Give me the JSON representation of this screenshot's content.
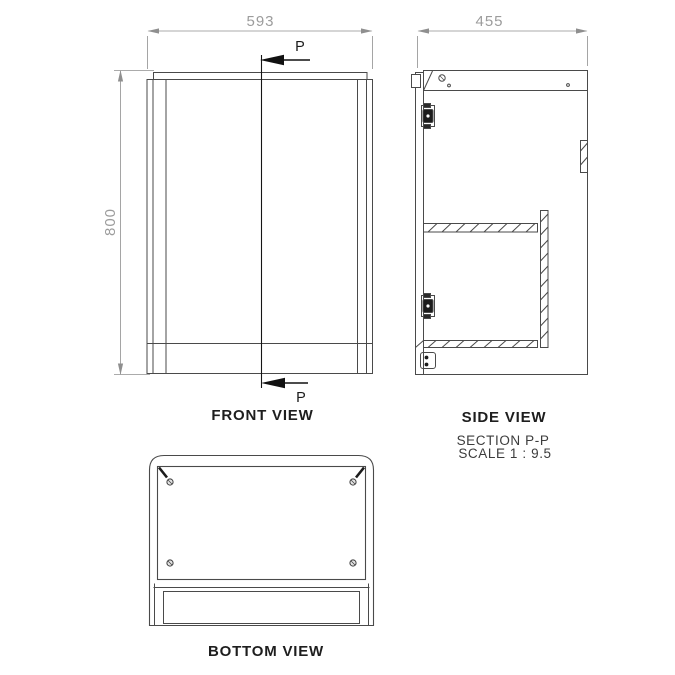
{
  "drawing": {
    "title_labels": {
      "front_view": "FRONT VIEW",
      "side_view": "SIDE VIEW",
      "section": "SECTION P-P",
      "scale": "SCALE 1 : 9.5",
      "bottom_view": "BOTTOM VIEW"
    },
    "dimensions": {
      "width": "593",
      "height": "800",
      "depth": "455"
    },
    "section_marker": "P",
    "colors": {
      "background": "#ffffff",
      "object_line": "#4a4a4a",
      "dimension_line": "#8f8f8f",
      "dimension_text": "#9c9c9c",
      "section_line": "#151515",
      "label_text": "#1e1e1e"
    }
  }
}
